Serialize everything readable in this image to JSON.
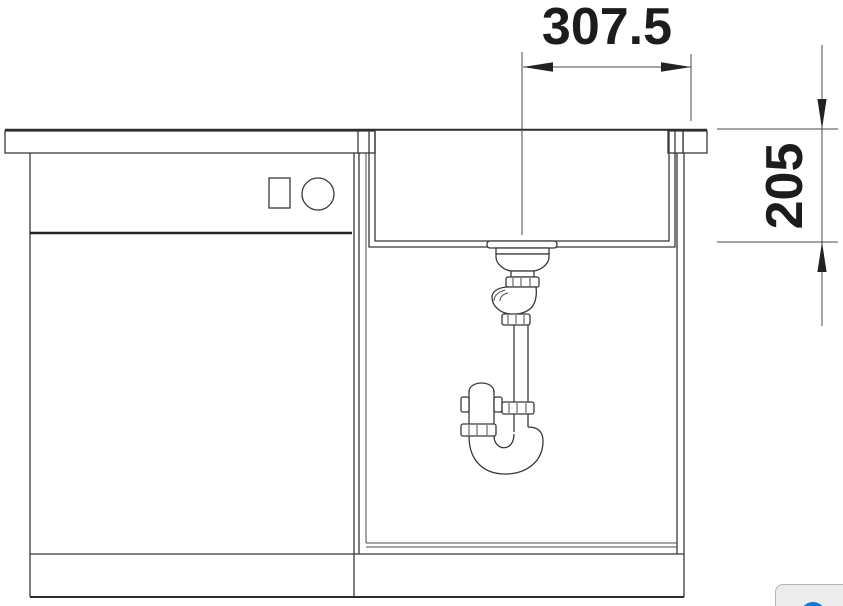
{
  "drawing": {
    "type": "sink-installation-section-drawing",
    "dim_width_label": "307.5",
    "dim_depth_label": "205",
    "line_color": "#383838"
  },
  "widget": {
    "blue": "#1778d3",
    "background": "#ececec",
    "border": "#b5b5b5"
  }
}
